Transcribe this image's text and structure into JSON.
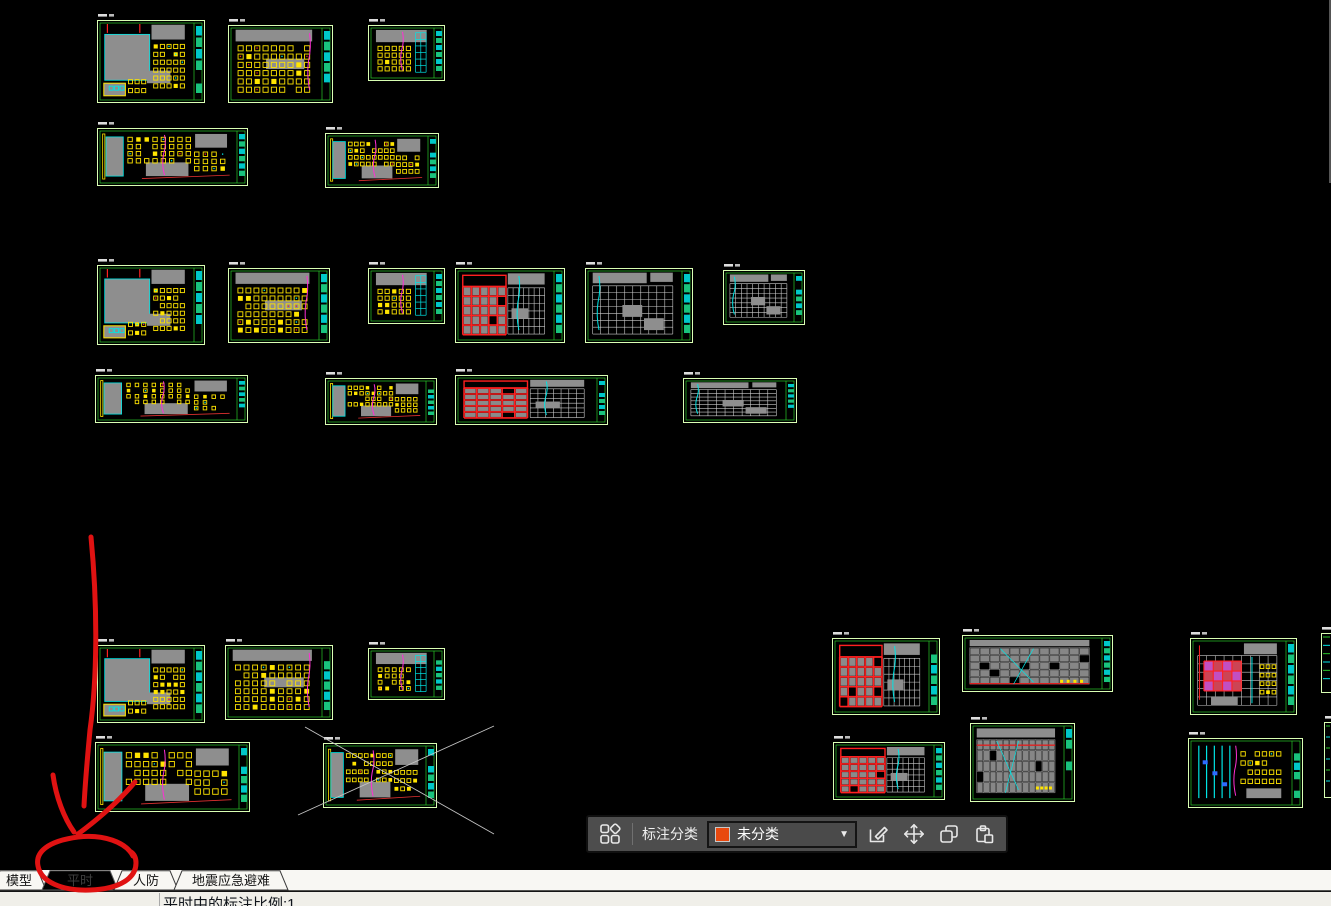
{
  "window": {
    "background": "#000000"
  },
  "canvas": {
    "background": "#000000",
    "palette": {
      "frame": "#d9ffb3",
      "green": "#28c828",
      "yellow": "#ffe400",
      "gray": "#8e8e8e",
      "cyan": "#00e5e5",
      "red": "#ff2020",
      "magenta": "#ff2fd4",
      "white_grid": "#c9c9c9"
    },
    "drawings": [
      {
        "x": 97,
        "y": 20,
        "w": 108,
        "h": 83,
        "v": "A",
        "seed": 11
      },
      {
        "x": 228,
        "y": 25,
        "w": 105,
        "h": 78,
        "v": "B",
        "seed": 22
      },
      {
        "x": 368,
        "y": 25,
        "w": 77,
        "h": 56,
        "v": "C",
        "seed": 33
      },
      {
        "x": 97,
        "y": 128,
        "w": 151,
        "h": 58,
        "v": "W",
        "seed": 44
      },
      {
        "x": 325,
        "y": 133,
        "w": 114,
        "h": 55,
        "v": "W",
        "seed": 55
      },
      {
        "x": 97,
        "y": 265,
        "w": 108,
        "h": 80,
        "v": "A",
        "seed": 66
      },
      {
        "x": 228,
        "y": 268,
        "w": 102,
        "h": 75,
        "v": "B",
        "seed": 77
      },
      {
        "x": 368,
        "y": 268,
        "w": 77,
        "h": 56,
        "v": "C",
        "seed": 88
      },
      {
        "x": 455,
        "y": 268,
        "w": 110,
        "h": 75,
        "v": "RG",
        "seed": 99
      },
      {
        "x": 585,
        "y": 268,
        "w": 108,
        "h": 75,
        "v": "WG",
        "seed": 110
      },
      {
        "x": 723,
        "y": 270,
        "w": 82,
        "h": 55,
        "v": "WG",
        "seed": 121
      },
      {
        "x": 95,
        "y": 375,
        "w": 153,
        "h": 48,
        "v": "W",
        "seed": 132
      },
      {
        "x": 325,
        "y": 378,
        "w": 112,
        "h": 47,
        "v": "W",
        "seed": 143
      },
      {
        "x": 455,
        "y": 375,
        "w": 153,
        "h": 50,
        "v": "RG",
        "seed": 154
      },
      {
        "x": 683,
        "y": 378,
        "w": 114,
        "h": 45,
        "v": "WG",
        "seed": 165
      },
      {
        "x": 97,
        "y": 645,
        "w": 108,
        "h": 78,
        "v": "A",
        "seed": 176
      },
      {
        "x": 225,
        "y": 645,
        "w": 108,
        "h": 75,
        "v": "B",
        "seed": 187
      },
      {
        "x": 368,
        "y": 648,
        "w": 77,
        "h": 52,
        "v": "C",
        "seed": 198
      },
      {
        "x": 95,
        "y": 742,
        "w": 155,
        "h": 70,
        "v": "W",
        "seed": 209
      },
      {
        "x": 323,
        "y": 743,
        "w": 114,
        "h": 65,
        "v": "W",
        "seed": 220
      },
      {
        "x": 832,
        "y": 638,
        "w": 108,
        "h": 77,
        "v": "RG",
        "seed": 231
      },
      {
        "x": 962,
        "y": 635,
        "w": 151,
        "h": 57,
        "v": "DG",
        "seed": 242
      },
      {
        "x": 1190,
        "y": 638,
        "w": 107,
        "h": 77,
        "v": "MG",
        "seed": 253
      },
      {
        "x": 833,
        "y": 742,
        "w": 112,
        "h": 58,
        "v": "RG",
        "seed": 264
      },
      {
        "x": 970,
        "y": 723,
        "w": 105,
        "h": 79,
        "v": "DG",
        "seed": 275
      },
      {
        "x": 1188,
        "y": 738,
        "w": 115,
        "h": 70,
        "v": "CY",
        "seed": 286
      },
      {
        "x": 1321,
        "y": 633,
        "w": 10,
        "h": 60,
        "v": "P",
        "seed": 297
      },
      {
        "x": 1324,
        "y": 722,
        "w": 7,
        "h": 76,
        "v": "P",
        "seed": 308
      }
    ],
    "construction_lines": [
      {
        "x1": 305,
        "y1": 727,
        "x2": 494,
        "y2": 834,
        "color": "#c4c4c4",
        "w": 0.9
      },
      {
        "x1": 298,
        "y1": 815,
        "x2": 494,
        "y2": 726,
        "color": "#c4c4c4",
        "w": 0.9
      },
      {
        "x1": 1330,
        "y1": 0,
        "x2": 1330,
        "y2": 183,
        "color": "#8d8d8d",
        "w": 1.2
      }
    ]
  },
  "annotation": {
    "color": "#e01212",
    "stroke_width": 5,
    "paths": [
      "M 91 537 C 98 610 97 680 90 730 C 87 762 85 786 84 806",
      "M 53 775 C 56 797 64 818 74 832",
      "M 135 782 C 119 801 97 820 78 834",
      "M 133 856 C 126 842 103 834 78 837 C 48 841 35 852 38 866 C 41 882 62 891 90 890 C 120 889 136 878 136 863 C 136 858 134 854 131 852"
    ]
  },
  "toolbar": {
    "label": "标注分类",
    "dropdown_value": "未分类",
    "swatch_color": "#e8490f",
    "icons": [
      {
        "name": "categories-icon"
      },
      {
        "name": "edit-annotation-icon"
      },
      {
        "name": "move-annotation-icon"
      },
      {
        "name": "copy-annotation-icon"
      },
      {
        "name": "paste-annotation-icon"
      }
    ]
  },
  "tabs": {
    "items": [
      {
        "name": "tab-model",
        "label": "模型",
        "x0": -6,
        "x1": 44,
        "active": false
      },
      {
        "name": "tab-pingshi",
        "label": "平时",
        "x0": 44,
        "x1": 116,
        "active": true
      },
      {
        "name": "tab-renfang",
        "label": "人防",
        "x0": 116,
        "x1": 176,
        "active": false
      },
      {
        "name": "tab-dizhen-yingji-binan",
        "label": "地震应急避难",
        "x0": 176,
        "x1": 286,
        "active": false
      }
    ]
  },
  "statusbar": {
    "text": "平时中的标注比例:1",
    "separator_x": 159
  }
}
